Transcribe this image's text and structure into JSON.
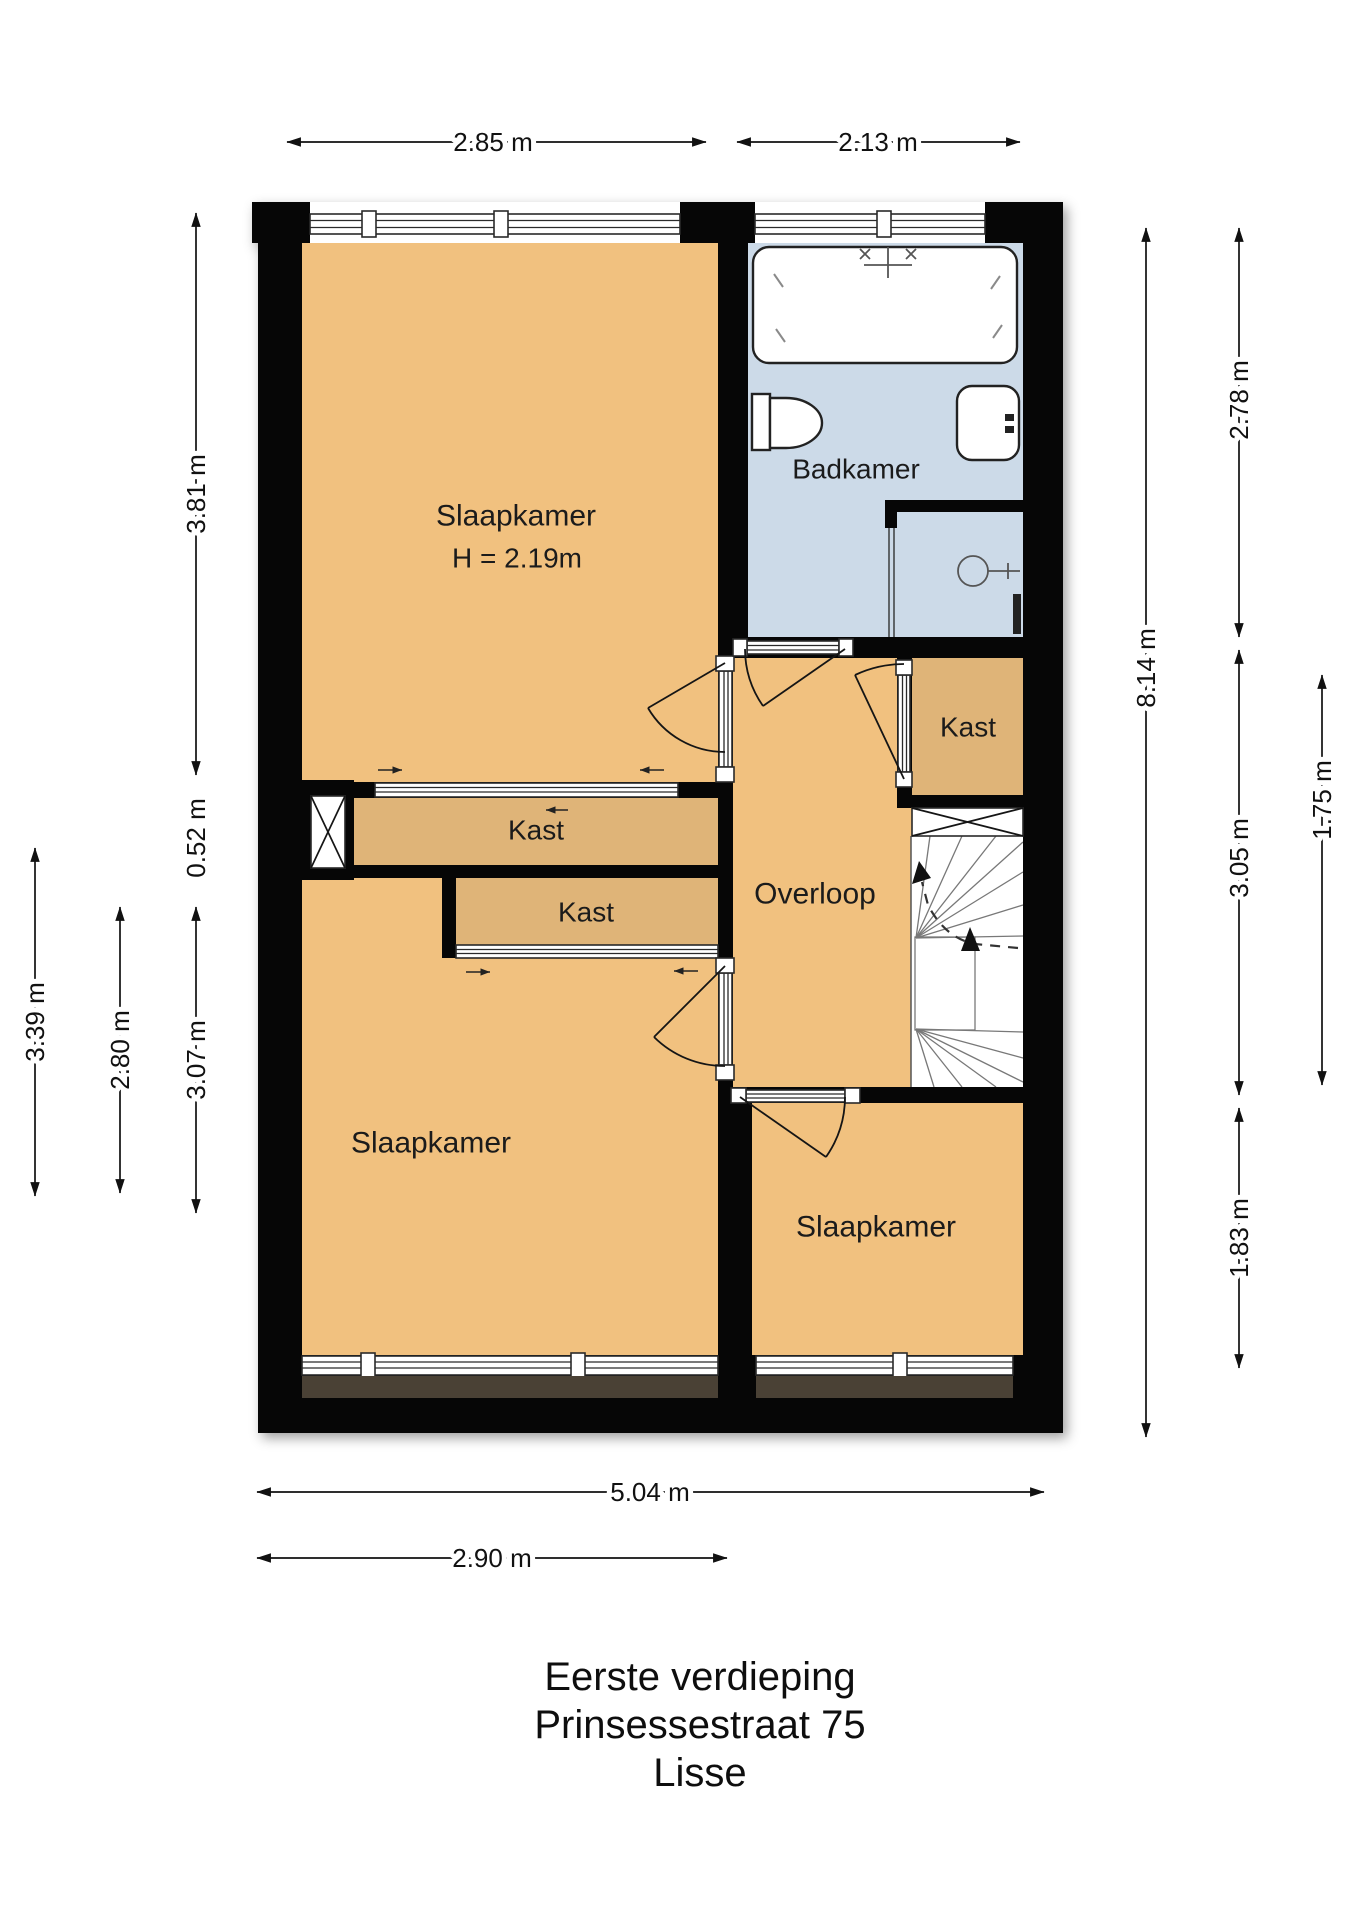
{
  "plan_title": {
    "line1": "Eerste verdieping",
    "line2": "Prinsessestraat 75",
    "line3": "Lisse"
  },
  "rooms": {
    "slaapkamer_top": {
      "label": "Slaapkamer",
      "height_note": "H = 2.19m"
    },
    "badkamer": {
      "label": "Badkamer"
    },
    "kast_right": {
      "label": "Kast"
    },
    "kast_upper": {
      "label": "Kast"
    },
    "kast_lower": {
      "label": "Kast"
    },
    "overloop": {
      "label": "Overloop"
    },
    "slaapkamer_left": {
      "label": "Slaapkamer"
    },
    "slaapkamer_right": {
      "label": "Slaapkamer"
    }
  },
  "dimensions": {
    "top_width_left": "2.85 m",
    "top_width_right": "2.13 m",
    "left_top_room": "3.81 m",
    "left_closet": "0.52 m",
    "left_outer": "3.39 m",
    "left_mid": "2.80 m",
    "left_bottom_room": "3.07 m",
    "right_bath": "2.78 m",
    "right_total": "8.14 m",
    "right_mid": "3.05 m",
    "right_stairs": "1.75 m",
    "right_bottom_room": "1.83 m",
    "bottom_total": "5.04 m",
    "bottom_left_room": "2.90 m"
  },
  "colors": {
    "room_fill": "#f1c17f",
    "closet_fill": "#dfb478",
    "bath_fill": "#ccdae8",
    "wall": "#060606",
    "window_sill_panel": "#4a4135",
    "background": "#ffffff",
    "text": "#111111"
  },
  "icons": {
    "bathtub-icon": "rounded rectangle with faucet cross",
    "toilet-icon": "cistern with bowl",
    "sink-icon": "rounded square with tap",
    "shower-head-icon": "circle with arm",
    "stairs-icon": "winder tread fan with up arrow",
    "flue-icon": "crossed box",
    "dimension-arrow-icon": "double-headed arrow"
  }
}
